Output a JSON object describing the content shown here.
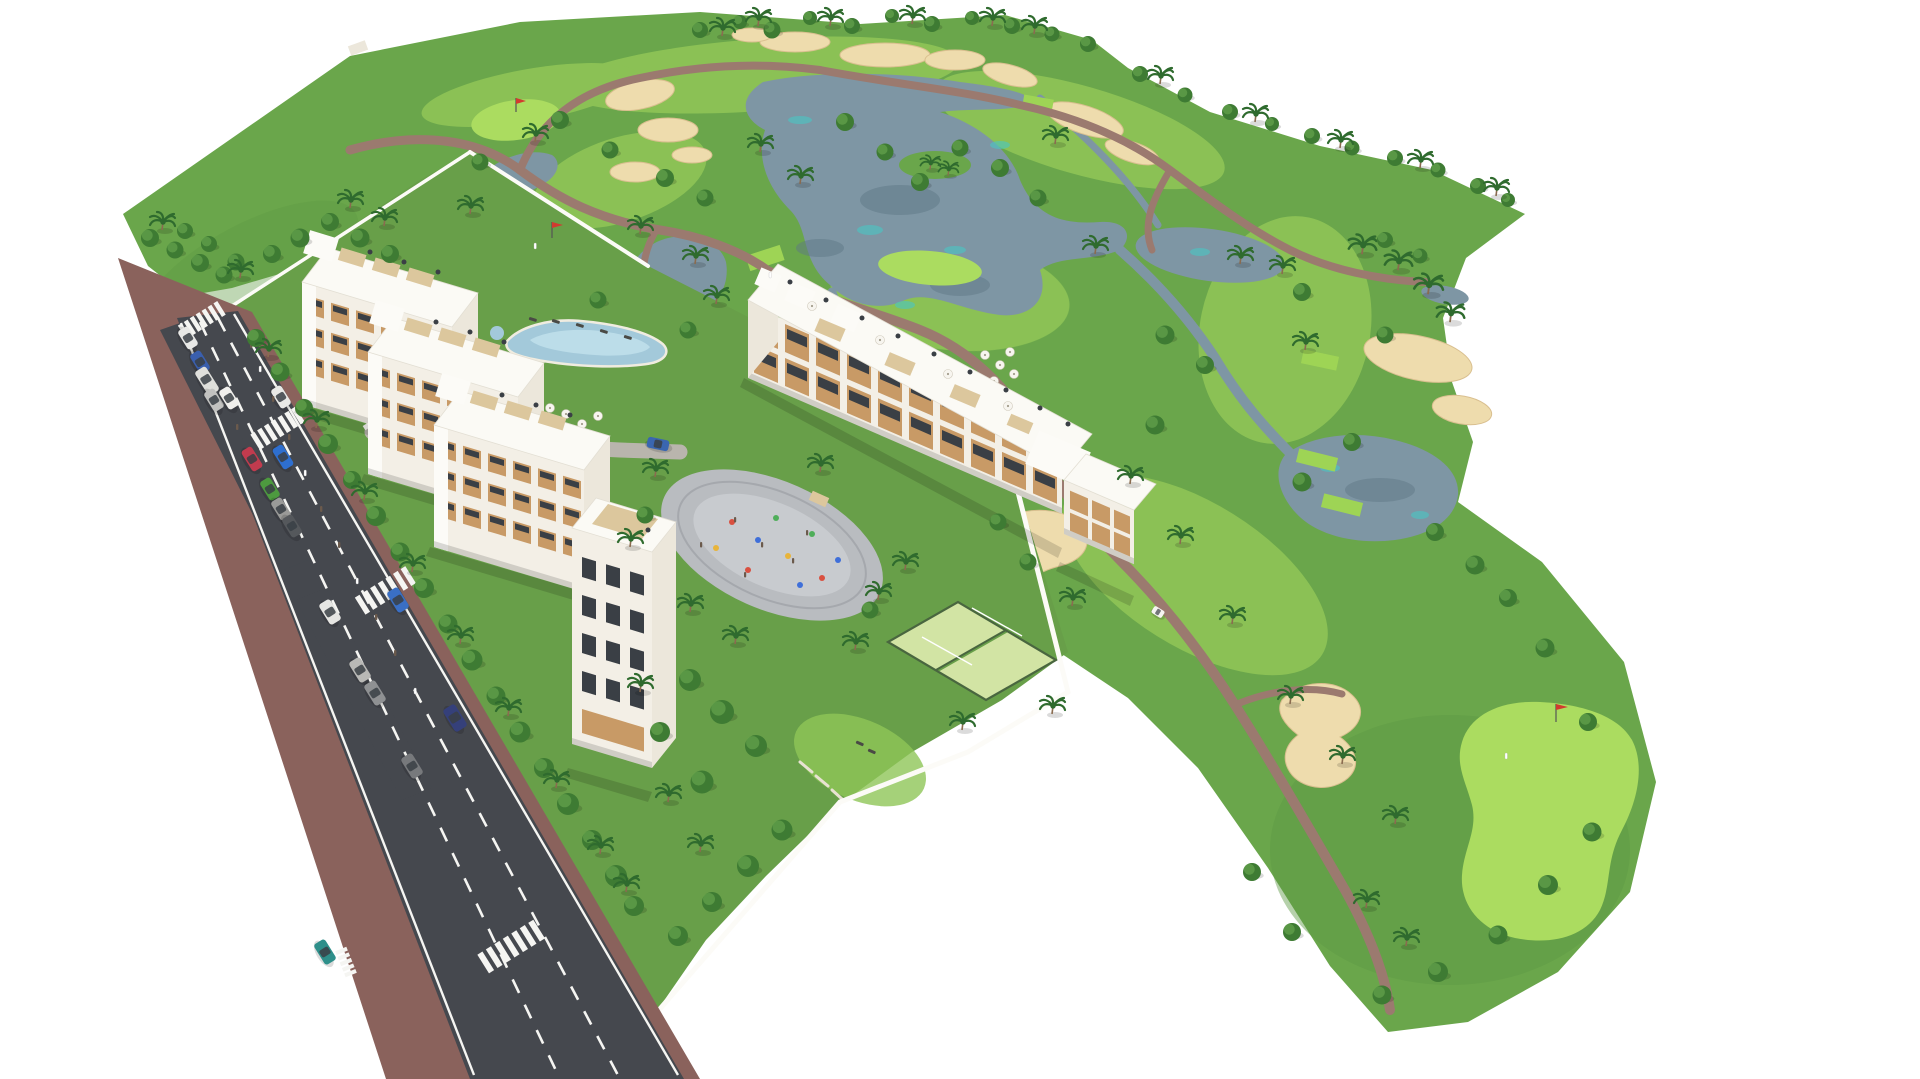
{
  "scene": {
    "type": "aerial-3d-architectural-render",
    "subject": "Aerial masterplan rendering of a white apartment complex beside a golf course",
    "background": "#ffffff"
  },
  "palette": {
    "bg": "#ffffff",
    "golf_grass": "#6aa64b",
    "golf_rough": "#5e9a44",
    "residential_lawn": "#689f49",
    "fairway": "#8fc557",
    "green_bright": "#abdc60",
    "tee_bright": "#9ed455",
    "sand": "#eedcad",
    "sand_edge": "#d9bf8f",
    "water": "#7e96a4",
    "water_deep": "#5f7886",
    "water_teal": "#49c6c4",
    "path": "#9b7a6f",
    "road": "#45484e",
    "road_line": "#f5f5f2",
    "sidewalk": "#8a625c",
    "wall": "#fcfbf7",
    "roof": "#fbfaf5",
    "roof_edge": "#e3dfd4",
    "facade": "#f3efe6",
    "gable": "#ece7db",
    "balcony_wood": "#c89a66",
    "pergola": "#dcc79d",
    "glass": "#3a3f45",
    "shadow": "rgba(0,0,0,0.14)",
    "tree_dark": "#3e7b33",
    "tree_light": "#6fae54",
    "frond": "#2f6b2e",
    "trunk": "#8a6b4f",
    "pool": "#a3c9da",
    "pool_light": "#bcdde9",
    "deck": "#f0ece0",
    "playground": "#b9bcc0",
    "playground_inner": "#c8cbcf",
    "padel": "#d2e4a4",
    "padel_fence": "#49663f",
    "umbrella": "#f7f5ef",
    "lounger": "#4a4a45",
    "flag": "#d23b2f",
    "cart": "#f5f4f0",
    "hedge": "#4c7c38",
    "drive": "#b9b5ad",
    "figure": "#6b5a4c",
    "eq_red": "#d95040",
    "eq_blue": "#3f6fd9",
    "eq_yellow": "#e8b43a",
    "eq_green": "#4fae5a"
  },
  "golf": {
    "lakes": 5,
    "streams": 2,
    "sand_bunkers": 18,
    "putting_greens": 4,
    "tee_boxes": 6,
    "flags": 3,
    "golfers": 3,
    "golf_carts": 1,
    "cart_paths": "winding mauve paths across the course"
  },
  "residential": {
    "blocks": [
      {
        "id": "block-a",
        "type": "4-storey white apartment slab with roof terraces"
      },
      {
        "id": "block-b",
        "type": "4-storey white apartment slab with roof terraces"
      },
      {
        "id": "block-c",
        "type": "4-storey white apartment slab with roof terraces"
      },
      {
        "id": "block-c-tower",
        "type": "5-storey corner tower with roof deck"
      },
      {
        "id": "block-d",
        "type": "long golf-side slab with timber loggias and roof terraces"
      },
      {
        "id": "block-e",
        "type": "small end pavilion"
      }
    ],
    "amenities": {
      "lagoon_pool": 1,
      "kids_pool": 1,
      "sun_umbrellas": 23,
      "sun_loungers": 7,
      "playground": 1,
      "padel_courts": 2,
      "perimeter_wall": "white rendered wall"
    }
  },
  "road": {
    "description": "two-lane avenue with parallel parking, red-brown sidewalks and zebra crossings",
    "crosswalks": 5,
    "cars": [
      {
        "color": "#e8e8e6",
        "state": "parked"
      },
      {
        "color": "#3a5fae",
        "state": "parked"
      },
      {
        "color": "#dfdfdb",
        "state": "parked-van"
      },
      {
        "color": "#c2c2c0",
        "state": "parked"
      },
      {
        "color": "#f0efec",
        "state": "driving"
      },
      {
        "color": "#e9e9e6",
        "state": "driving"
      },
      {
        "color": "#c23b4e",
        "state": "driving"
      },
      {
        "color": "#2e6fd0",
        "state": "driving"
      },
      {
        "color": "#4d9a3f",
        "state": "driving"
      },
      {
        "color": "#9a9a98",
        "state": "driving"
      },
      {
        "color": "#55585c",
        "state": "driving"
      },
      {
        "color": "#e6e6e3",
        "state": "parked"
      },
      {
        "color": "#b9b9b6",
        "state": "parked"
      },
      {
        "color": "#8f9193",
        "state": "parked"
      },
      {
        "color": "#77797c",
        "state": "parked"
      },
      {
        "color": "#35407a",
        "state": "driving"
      },
      {
        "color": "#3a6fc4",
        "state": "driving"
      },
      {
        "color": "#2e8f8a",
        "state": "driving"
      },
      {
        "color": "#3a66b0",
        "state": "parked-courtyard"
      }
    ]
  },
  "vegetation": {
    "round_trees": 97,
    "palm_trees": 64
  }
}
